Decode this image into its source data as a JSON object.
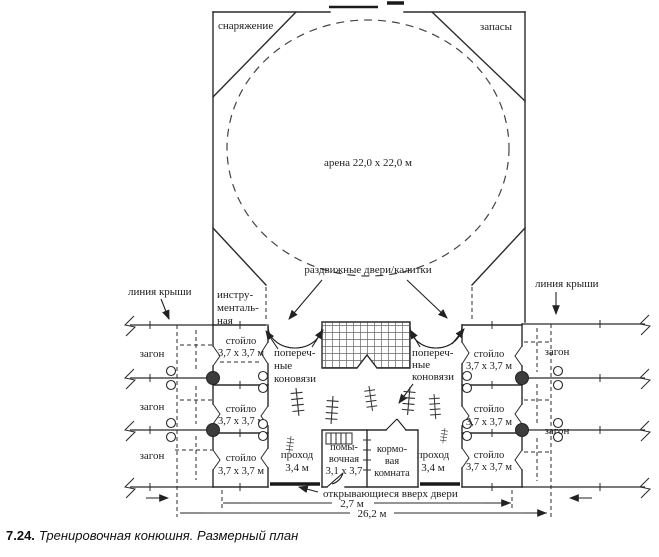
{
  "figure": {
    "caption_number": "7.24.",
    "caption_title": "Тренировочная конюшня. Размерный план"
  },
  "arena": {
    "label": "арена 22,0 x 22,0 м",
    "equipment_room": "снаряжение",
    "supplies_room": "запасы",
    "sliding_doors_label": "раздвижные двери/калитки",
    "tool_room_lines": [
      "инстру-",
      "менталь-",
      "ная"
    ]
  },
  "stable": {
    "roof_line_left": "линия крыши",
    "roof_line_right": "линия крыши",
    "pens_left": [
      "загон",
      "загон",
      "загон"
    ],
    "pens_right": [
      "загон",
      "загон"
    ],
    "stall_name": "стойло",
    "stall_size": "3,7 x 3,7 м",
    "cross_ties_lines": [
      "попереч-",
      "ные",
      "коновязи"
    ],
    "aisle_name": "проход",
    "aisle_size": "3,4 м",
    "washing_room_lines": [
      "помы-",
      "вочная",
      "3,1 x 3,7"
    ],
    "feed_room_lines": [
      "кормо-",
      "вая",
      "комната"
    ],
    "up_doors_label": "открывающиеся вверх двери"
  },
  "dimensions": {
    "inner_span": "2,7 м",
    "total_span": "26,2 м"
  },
  "colors": {
    "ink": "#222222",
    "paper": "#ffffff"
  }
}
